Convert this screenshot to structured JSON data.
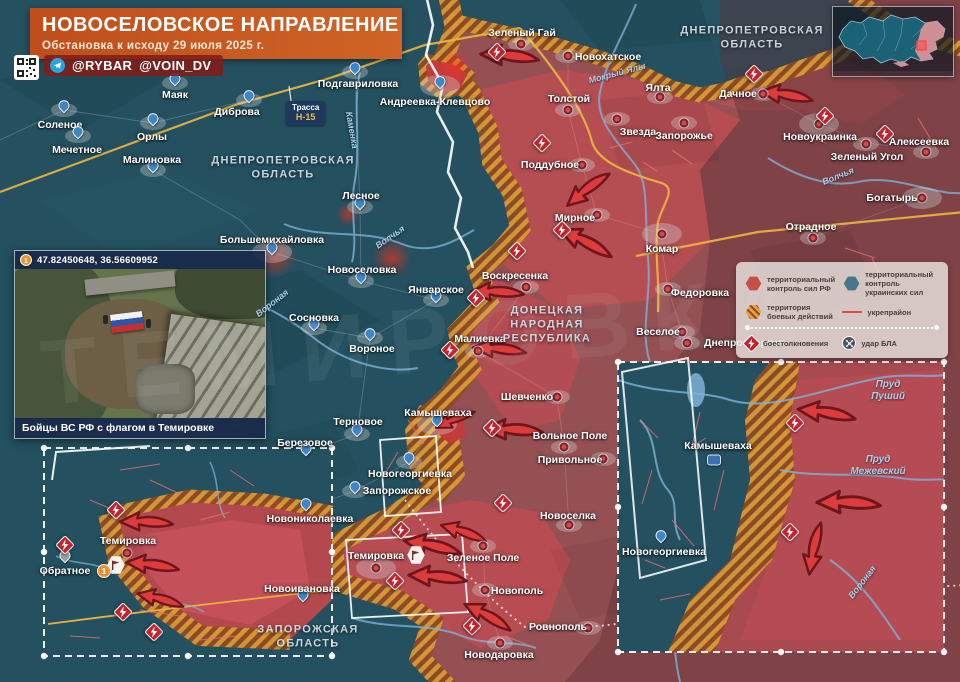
{
  "header": {
    "title": "НОВОСЕЛОВСКОЕ НАПРАВЛЕНИЕ",
    "subtitle": "Обстановка к исходу 29 июля 2025 г.",
    "handles": [
      "@RYBAR",
      "@VOIN_DV"
    ]
  },
  "colors": {
    "ua_control": "#49778a",
    "rf_control": "#c65048",
    "combat_zone": "#e0a43c",
    "ukrep_line": "#e04848",
    "accent_header": "#cf6426"
  },
  "legend": {
    "items": [
      {
        "icon": "rf-control-hex",
        "label": "территориальный контроль сил РФ"
      },
      {
        "icon": "ua-control-hex",
        "label": "территориальный контроль украинских сил"
      },
      {
        "icon": "combat-zone-hex",
        "label": "территория боевых действий"
      },
      {
        "icon": "ukrep-line",
        "label": "укрепрайон"
      },
      {
        "icon": "clash-icon",
        "label": "боестолкновения"
      },
      {
        "icon": "drone-icon",
        "label": "удар БЛА"
      }
    ]
  },
  "photo": {
    "badge": "1",
    "coords": "47.82450648, 36.56609952",
    "caption": "Бойцы ВС РФ с флагом в Темировке"
  },
  "road_sign": {
    "line1": "Трасса",
    "line2": "Н-15"
  },
  "watermark": "ТЕМИРОВКА",
  "map": {
    "regions": [
      {
        "lines": "ДНЕПРОПЕТРОВСКАЯ\nОБЛАСТЬ",
        "x": 283,
        "y": 168
      },
      {
        "lines": "ДНЕПРОПЕТРОВСКАЯ\nОБЛАСТЬ",
        "x": 752,
        "y": 38
      },
      {
        "lines": "ДОНЕЦКАЯ\nНАРОДНАЯ\nРЕСПУБЛИКА",
        "x": 547,
        "y": 325
      },
      {
        "lines": "ЗАПОРОЖСКАЯ\nОБЛАСТЬ",
        "x": 308,
        "y": 637
      }
    ],
    "settlements": [
      {
        "n": "Маяк",
        "lx": 175,
        "ly": 95,
        "mx": 175,
        "my": 83,
        "t": "ua"
      },
      {
        "n": "Соленое",
        "lx": 60,
        "ly": 125,
        "mx": 64,
        "my": 110,
        "t": "ua"
      },
      {
        "n": "Орлы",
        "lx": 152,
        "ly": 137,
        "mx": 153,
        "my": 123,
        "t": "ua"
      },
      {
        "n": "Мечетное",
        "lx": 77,
        "ly": 150,
        "mx": 78,
        "my": 136,
        "t": "ua"
      },
      {
        "n": "Малиновка",
        "lx": 152,
        "ly": 160,
        "mx": 153,
        "my": 170,
        "t": "ua"
      },
      {
        "n": "Диброва",
        "lx": 237,
        "ly": 112,
        "mx": 249,
        "my": 100,
        "t": "ua"
      },
      {
        "n": "Подгавриловка",
        "lx": 358,
        "ly": 84,
        "mx": 355,
        "my": 72,
        "t": "ua"
      },
      {
        "n": "Андреевка-Клевцово",
        "lx": 435,
        "ly": 102,
        "mx": 440,
        "my": 86,
        "t": "ua",
        "b": 1
      },
      {
        "n": "Лесное",
        "lx": 361,
        "ly": 196,
        "mx": 360,
        "my": 207,
        "t": "ua"
      },
      {
        "n": "Большемихайловка",
        "lx": 272,
        "ly": 240,
        "mx": 272,
        "my": 252,
        "t": "ua",
        "b": 1
      },
      {
        "n": "Новоселовка",
        "lx": 362,
        "ly": 270,
        "mx": 361,
        "my": 281,
        "t": "ua"
      },
      {
        "n": "Январское",
        "lx": 436,
        "ly": 290,
        "mx": 436,
        "my": 300,
        "t": "ua"
      },
      {
        "n": "Сосновка",
        "lx": 314,
        "ly": 318,
        "mx": 314,
        "my": 328,
        "t": "ua"
      },
      {
        "n": "Вороное",
        "lx": 372,
        "ly": 349,
        "mx": 370,
        "my": 338,
        "t": "ua"
      },
      {
        "n": "Терновое",
        "lx": 358,
        "ly": 422,
        "mx": 357,
        "my": 434,
        "t": "ua"
      },
      {
        "n": "Березовое",
        "lx": 305,
        "ly": 443,
        "mx": 306,
        "my": 453,
        "t": "ua"
      },
      {
        "n": "Камышеваха",
        "lx": 438,
        "ly": 413,
        "mx": 437,
        "my": 424,
        "t": "ua",
        "b": 1
      },
      {
        "n": "Новогеоргиевка",
        "lx": 410,
        "ly": 474,
        "mx": 409,
        "my": 462,
        "t": "ua"
      },
      {
        "n": "Запорожское",
        "lx": 397,
        "ly": 491,
        "mx": 355,
        "my": 491,
        "t": "ua"
      },
      {
        "n": "Новониколаевка",
        "lx": 310,
        "ly": 519,
        "mx": 306,
        "my": 508,
        "t": "ua"
      },
      {
        "n": "Новоивановка",
        "lx": 302,
        "ly": 589,
        "mx": 303,
        "my": 599,
        "t": "ua"
      },
      {
        "n": "Зеленый Гай",
        "lx": 522,
        "ly": 33,
        "mx": 521,
        "my": 44,
        "t": "ru"
      },
      {
        "n": "Новохатское",
        "lx": 608,
        "ly": 57,
        "mx": 568,
        "my": 56,
        "t": "ru"
      },
      {
        "n": "Толстой",
        "lx": 569,
        "ly": 99,
        "mx": 568,
        "my": 110,
        "t": "ru"
      },
      {
        "n": "Ялта",
        "lx": 658,
        "ly": 88,
        "mx": 660,
        "my": 97,
        "t": "ru"
      },
      {
        "n": "Звезда",
        "lx": 638,
        "ly": 132,
        "mx": 617,
        "my": 119,
        "t": "ru"
      },
      {
        "n": "Запорожье",
        "lx": 684,
        "ly": 136,
        "mx": 684,
        "my": 123,
        "t": "ru"
      },
      {
        "n": "Дачное",
        "lx": 738,
        "ly": 94,
        "mx": 763,
        "my": 94,
        "t": "ru"
      },
      {
        "n": "Новоукраинка",
        "lx": 820,
        "ly": 137,
        "mx": 819,
        "my": 124,
        "t": "ru",
        "b": 1
      },
      {
        "n": "Алексеевка",
        "lx": 919,
        "ly": 142,
        "mx": 926,
        "my": 152,
        "t": "ru"
      },
      {
        "n": "Зеленый Угол",
        "lx": 867,
        "ly": 157,
        "mx": 866,
        "my": 144,
        "t": "ru"
      },
      {
        "n": "Богатырь",
        "lx": 892,
        "ly": 198,
        "mx": 922,
        "my": 198,
        "t": "ru",
        "b": 1
      },
      {
        "n": "Отрадное",
        "lx": 811,
        "ly": 227,
        "mx": 813,
        "my": 238,
        "t": "ru"
      },
      {
        "n": "Поддубное",
        "lx": 550,
        "ly": 165,
        "mx": 582,
        "my": 165,
        "t": "ru"
      },
      {
        "n": "Мирное",
        "lx": 575,
        "ly": 218,
        "mx": 597,
        "my": 215,
        "t": "ru"
      },
      {
        "n": "Комар",
        "lx": 662,
        "ly": 249,
        "mx": 662,
        "my": 234,
        "t": "ru",
        "b": 1
      },
      {
        "n": "Федоровка",
        "lx": 700,
        "ly": 293,
        "mx": 668,
        "my": 289,
        "t": "ru"
      },
      {
        "n": "Веселое",
        "lx": 658,
        "ly": 332,
        "mx": 682,
        "my": 332,
        "t": "ru"
      },
      {
        "n": "Днепроэнергия",
        "lx": 744,
        "ly": 343,
        "mx": 687,
        "my": 343,
        "t": "ru"
      },
      {
        "n": "Воскресенка",
        "lx": 515,
        "ly": 276,
        "mx": 526,
        "my": 287,
        "t": "ru"
      },
      {
        "n": "Малиевка",
        "lx": 480,
        "ly": 339,
        "mx": 478,
        "my": 351,
        "t": "ru"
      },
      {
        "n": "Шевченко",
        "lx": 527,
        "ly": 397,
        "mx": 557,
        "my": 397,
        "t": "ru"
      },
      {
        "n": "Вольное Поле",
        "lx": 570,
        "ly": 436,
        "mx": 564,
        "my": 447,
        "t": "ru"
      },
      {
        "n": "Привольное",
        "lx": 570,
        "ly": 460,
        "mx": 603,
        "my": 459,
        "t": "ru"
      },
      {
        "n": "Новоселка",
        "lx": 568,
        "ly": 516,
        "mx": 569,
        "my": 525,
        "t": "ru"
      },
      {
        "n": "Зеленое Поле",
        "lx": 483,
        "ly": 558,
        "mx": 483,
        "my": 546,
        "t": "ru"
      },
      {
        "n": "Темировка",
        "lx": 376,
        "ly": 556,
        "mx": 376,
        "my": 568,
        "t": "ru",
        "b": 1
      },
      {
        "n": "Новополь",
        "lx": 517,
        "ly": 591,
        "mx": 485,
        "my": 590,
        "t": "ru"
      },
      {
        "n": "Ровнополь",
        "lx": 558,
        "ly": 627,
        "mx": 588,
        "my": 628,
        "t": "ru"
      },
      {
        "n": "Новодаровка",
        "lx": 499,
        "ly": 655,
        "mx": 500,
        "my": 643,
        "t": "ru"
      },
      {
        "n": "Обратное",
        "lx": 65,
        "ly": 571,
        "mx": 65,
        "my": 560,
        "t": "na"
      },
      {
        "n": "Темировка",
        "lx": 128,
        "ly": 541,
        "mx": 127,
        "my": 553,
        "t": "ru"
      },
      {
        "n": "Камышеваха",
        "lx": 718,
        "ly": 446,
        "mx": 714,
        "my": 460,
        "t": "unit",
        "b": 1
      },
      {
        "n": "Новогеоргиевка",
        "lx": 664,
        "ly": 552,
        "mx": 661,
        "my": 540,
        "t": "ua"
      }
    ],
    "rivers": [
      {
        "n": "Мокрый Ялы",
        "x": 617,
        "y": 73,
        "r": -15
      },
      {
        "n": "Волчья",
        "x": 838,
        "y": 176,
        "r": -22
      },
      {
        "n": "Волчья",
        "x": 390,
        "y": 237,
        "r": -35
      },
      {
        "n": "Вороная",
        "x": 272,
        "y": 303,
        "r": -38
      },
      {
        "n": "Каменка",
        "x": 352,
        "y": 130,
        "r": 80
      },
      {
        "n": "Вороная",
        "x": 862,
        "y": 582,
        "r": -52
      }
    ],
    "ponds": [
      {
        "lines": "Пруд\nПуший",
        "x": 888,
        "y": 391
      },
      {
        "lines": "Пруд\nМежевский",
        "x": 878,
        "y": 466
      }
    ],
    "flags": [
      {
        "x": 416,
        "y": 555
      },
      {
        "x": 116,
        "y": 565
      }
    ],
    "photo_refs": [
      {
        "x": 104,
        "y": 571,
        "label": "1"
      }
    ],
    "explosions": [
      [
        497,
        52
      ],
      [
        542,
        143
      ],
      [
        754,
        74
      ],
      [
        825,
        116
      ],
      [
        885,
        134
      ],
      [
        562,
        230
      ],
      [
        517,
        251
      ],
      [
        476,
        298
      ],
      [
        450,
        350
      ],
      [
        492,
        428
      ],
      [
        503,
        503
      ],
      [
        401,
        530
      ],
      [
        395,
        581
      ],
      [
        472,
        626
      ],
      [
        116,
        510
      ],
      [
        65,
        545
      ],
      [
        123,
        612
      ],
      [
        154,
        632
      ],
      [
        795,
        423
      ],
      [
        790,
        532
      ]
    ],
    "arrows": [
      {
        "x": 509,
        "y": 57,
        "r": 8,
        "s": 1.1
      },
      {
        "x": 786,
        "y": 96,
        "r": 12,
        "s": 1
      },
      {
        "x": 588,
        "y": 190,
        "r": -35,
        "s": 1
      },
      {
        "x": 585,
        "y": 243,
        "r": 30,
        "s": 1.1
      },
      {
        "x": 497,
        "y": 293,
        "r": 5,
        "s": 1
      },
      {
        "x": 499,
        "y": 350,
        "r": 8,
        "s": 1
      },
      {
        "x": 513,
        "y": 431,
        "r": 5,
        "s": 1.1
      },
      {
        "x": 455,
        "y": 420,
        "r": -20,
        "s": 0.8
      },
      {
        "x": 463,
        "y": 533,
        "r": 22,
        "s": 0.9
      },
      {
        "x": 432,
        "y": 547,
        "r": 15,
        "s": 1.1
      },
      {
        "x": 437,
        "y": 578,
        "r": 8,
        "s": 1.1
      },
      {
        "x": 487,
        "y": 617,
        "r": 32,
        "s": 1
      },
      {
        "x": 146,
        "y": 523,
        "r": 5,
        "s": 1
      },
      {
        "x": 152,
        "y": 566,
        "r": 10,
        "s": 1
      },
      {
        "x": 160,
        "y": 600,
        "r": 18,
        "s": 0.9
      },
      {
        "x": 826,
        "y": 414,
        "r": 12,
        "s": 1.1
      },
      {
        "x": 848,
        "y": 504,
        "r": 5,
        "s": 1.2
      },
      {
        "x": 815,
        "y": 549,
        "r": -75,
        "s": 1
      }
    ]
  }
}
